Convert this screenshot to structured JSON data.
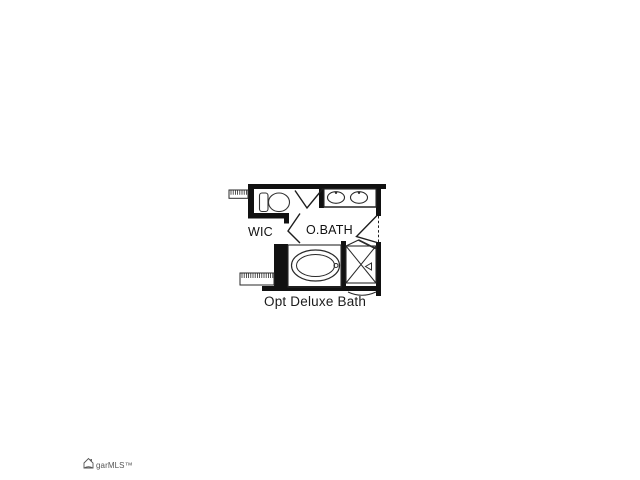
{
  "canvas": {
    "background": "#ffffff",
    "wall_color": "#111111",
    "fixture_line_color": "#2a2a2a"
  },
  "floor_plan": {
    "caption": "Opt Deluxe Bath",
    "rooms": [
      {
        "label": "WIC"
      },
      {
        "label": "O.BATH"
      }
    ],
    "fixtures": [
      "toilet",
      "double-sink-vanity",
      "oval-bathtub",
      "shower-stall",
      "closet-shelves",
      "door-swings"
    ]
  },
  "watermark": {
    "text": "garMLS™",
    "icon": "house-logo-icon"
  }
}
